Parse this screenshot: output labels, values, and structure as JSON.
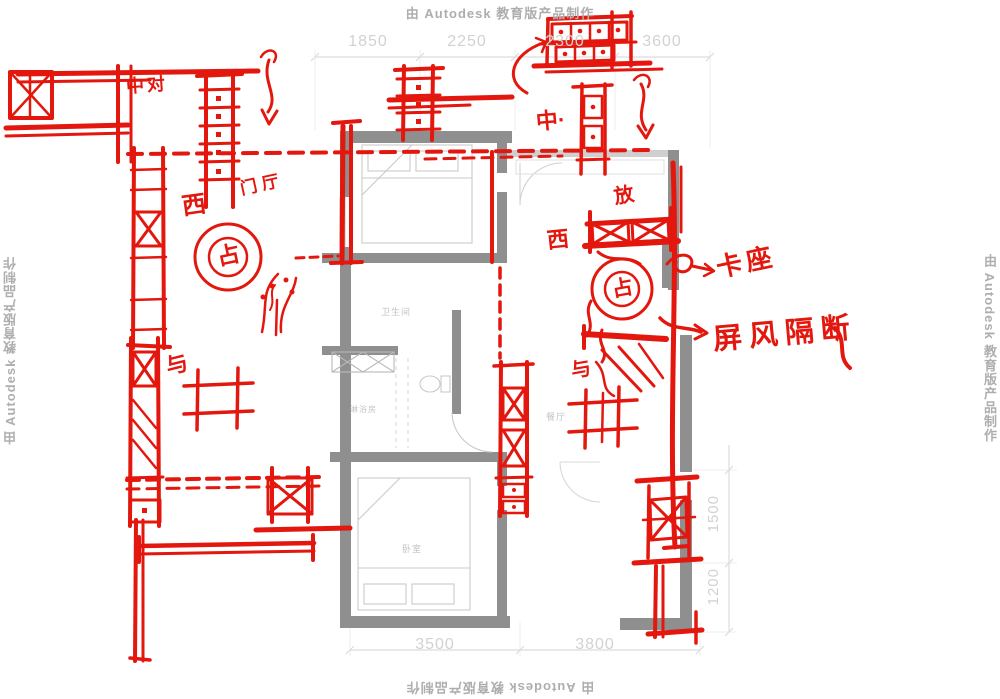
{
  "watermark": {
    "top": "由 Autodesk 教育版产品制作",
    "bottom": "由 Autodesk 教育版产品制作",
    "left": "由 Autodesk 教育版产品制作",
    "right": "由 Autodesk 教育版产品制作"
  },
  "dimensions": {
    "top": [
      "1850",
      "2250",
      "2300",
      "3600"
    ],
    "bottom": [
      "3500",
      "3800"
    ],
    "right": [
      "1500",
      "1200"
    ]
  },
  "rooms": {
    "bathroom": "卫生间",
    "shower": "淋浴房",
    "bedroom": "卧室",
    "dining": "餐厅"
  },
  "sketch": {
    "labels": {
      "top_left": "中对",
      "west_left": "西",
      "hall": "门厅",
      "center_top": "中·",
      "fang": "放",
      "west_right": "西",
      "booth": "卡座",
      "screen": "屏风隔断",
      "flue_left": "占",
      "flue_right": "占",
      "scribble_left": "与",
      "scribble_right": "与"
    }
  },
  "colors": {
    "sketch_red": "#e3170d",
    "wall_gray": "#8f8f8f",
    "fixture_gray": "#c9c9c9",
    "dim_gray": "#d2d2d2",
    "watermark_gray": "#aeaeae"
  }
}
